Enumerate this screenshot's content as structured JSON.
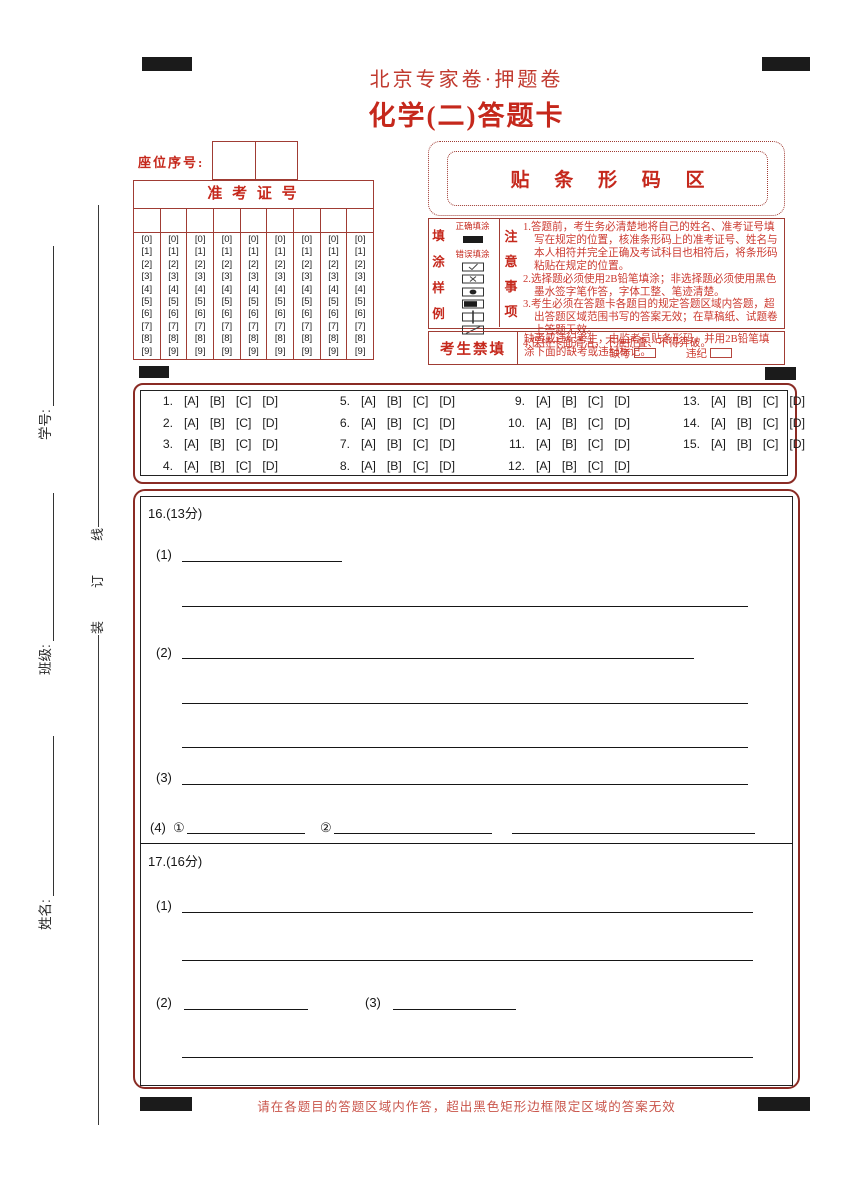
{
  "page": {
    "title_small": "北京专家卷·押题卷",
    "title_main": "化学(二)答题卡",
    "footer_note": "请在各题目的答题区域内作答，超出黑色矩形边框限定区域的答案无效"
  },
  "colors": {
    "title_red": "#c5281c",
    "border_maroon": "#8a2b24",
    "table_red": "#a03c34",
    "note_red": "#cc3a30",
    "ink_black": "#1c1c1c"
  },
  "sidebar": {
    "binding_text": "装订线",
    "fields": [
      {
        "label": "学号:"
      },
      {
        "label": "班级:"
      },
      {
        "label": "姓名:"
      }
    ]
  },
  "seat": {
    "label": "座位序号:"
  },
  "ticket_grid": {
    "title": "准 考 证 号",
    "columns": 9,
    "digits": [
      "[0]",
      "[1]",
      "[2]",
      "[3]",
      "[4]",
      "[5]",
      "[6]",
      "[7]",
      "[8]",
      "[9]"
    ]
  },
  "barcode": {
    "label": "贴 条 形 码 区"
  },
  "fill_sample": {
    "column_label": "填涂样例",
    "correct_label": "正确填涂",
    "wrong_label": "错误填涂",
    "wrong_marks": [
      "check-mark",
      "cross-mark",
      "dot-mark",
      "heavy-fill-mark",
      "vertical-line-mark",
      "diagonal-mark"
    ]
  },
  "notice": {
    "column_label": "注意事项",
    "items": [
      "1.答题前，考生务必清楚地将自己的姓名、准考证号填写在规定的位置，核准条形码上的准考证号、姓名与本人相符并完全正确及考试科目也相符后，将条形码粘贴在规定的位置。",
      "2.选择题必须使用2B铅笔填涂；非选择题必须使用黑色墨水签字笔作答，字体工整、笔迹清楚。",
      "3.考生必须在答题卡各题目的规定答题区域内答题，超出答题区域范围书写的答案无效；在草稿纸、试题卷上答题无效。",
      "4.保持卡面清洁，不准折叠、不得弄破。"
    ]
  },
  "forbidden": {
    "label": "考生禁填",
    "text": "缺考或违纪考生，由监考员贴条形码，并用2B铅笔填涂下面的缺考或违纪标记。",
    "absent_label": "缺考",
    "violation_label": "违纪"
  },
  "objective": {
    "options": [
      "[A]",
      "[B]",
      "[C]",
      "[D]"
    ],
    "columns": [
      [
        1,
        2,
        3,
        4
      ],
      [
        5,
        6,
        7,
        8
      ],
      [
        9,
        10,
        11,
        12
      ],
      [
        13,
        14,
        15
      ]
    ]
  },
  "subjective": {
    "q16": {
      "heading": "16.(13分)",
      "p1": "(1)",
      "p2": "(2)",
      "p3": "(3)",
      "p4": "(4)",
      "sub1": "①",
      "sub2": "②"
    },
    "q17": {
      "heading": "17.(16分)",
      "p1": "(1)",
      "p2": "(2)",
      "p3": "(3)"
    }
  }
}
